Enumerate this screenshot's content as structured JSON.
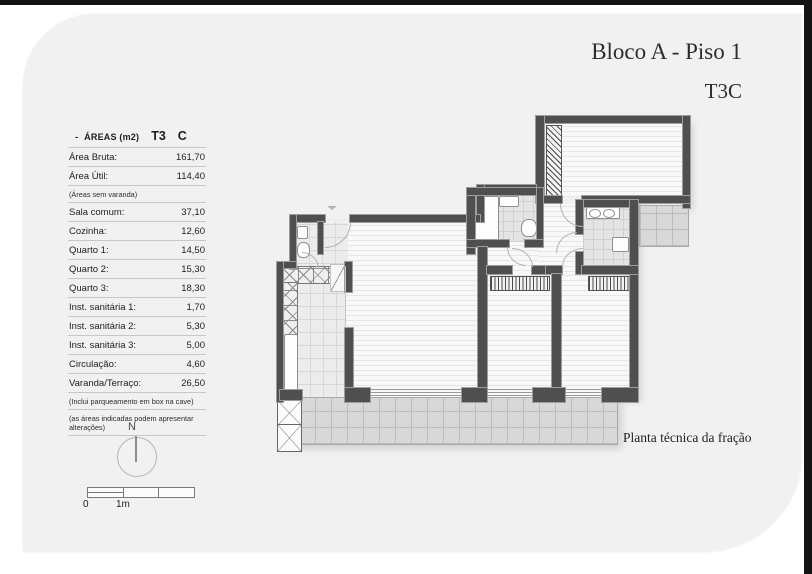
{
  "header": {
    "title_line1": "Bloco A - Piso 1",
    "title_line2": "T3C"
  },
  "areas_table": {
    "bullet": "-",
    "title": "ÁREAS (m2)",
    "type_label": "T3",
    "fraction_label": "C",
    "summary_rows": [
      {
        "label": "Área Bruta:",
        "value": "161,70"
      },
      {
        "label": "Área Útil:",
        "value": "114,40"
      }
    ],
    "summary_note": "(Áreas sem varanda)",
    "rows": [
      {
        "label": "Sala comum:",
        "value": "37,10"
      },
      {
        "label": "Cozinha:",
        "value": "12,60"
      },
      {
        "label": "Quarto 1:",
        "value": "14,50"
      },
      {
        "label": "Quarto 2:",
        "value": "15,30"
      },
      {
        "label": "Quarto 3:",
        "value": "18,30"
      },
      {
        "label": "Inst. sanitária 1:",
        "value": "1,70"
      },
      {
        "label": "Inst. sanitária 2:",
        "value": "5,30"
      },
      {
        "label": "Inst. sanitária 3:",
        "value": "5,00"
      },
      {
        "label": "Circulação:",
        "value": "4,60"
      },
      {
        "label": "Varanda/Terraço:",
        "value": "26,50"
      }
    ],
    "footnotes": [
      "(Inclui parqueamento em box na cave)",
      "(as áreas indicadas podem apresentar alterações)"
    ]
  },
  "compass": {
    "label": "N"
  },
  "scale_bar": {
    "zero_label": "0",
    "one_label": "1m"
  },
  "plan": {
    "unit_label": "T3",
    "caption": "Planta técnica da fração"
  },
  "colors": {
    "frame": "#141414",
    "card_bg": "#f1f1f1",
    "wall": "#4f4f4f",
    "terrace": "#d8d8d8"
  }
}
